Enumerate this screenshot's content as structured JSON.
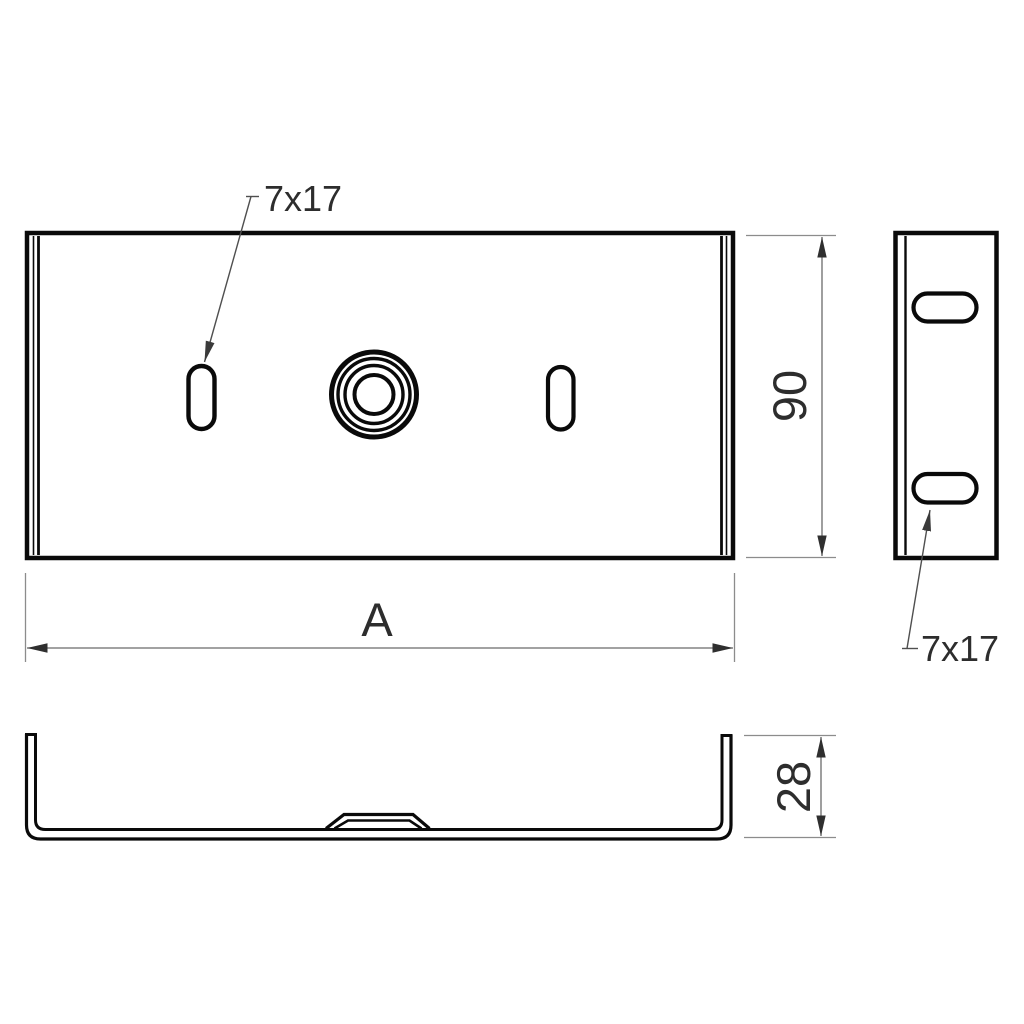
{
  "drawing": {
    "labels": {
      "front_slot": "7x17",
      "side_slot": "7x17"
    },
    "dimensions": {
      "width": "A",
      "height": "90",
      "depth": "28"
    },
    "colors": {
      "geometry_line": "#0a0a0a",
      "dimension_line": "#6b6b6b",
      "extension_line": "#8c8c8c",
      "leader_line": "#4f4f4f",
      "text": "#2d2d2d",
      "background": "#ffffff"
    }
  }
}
